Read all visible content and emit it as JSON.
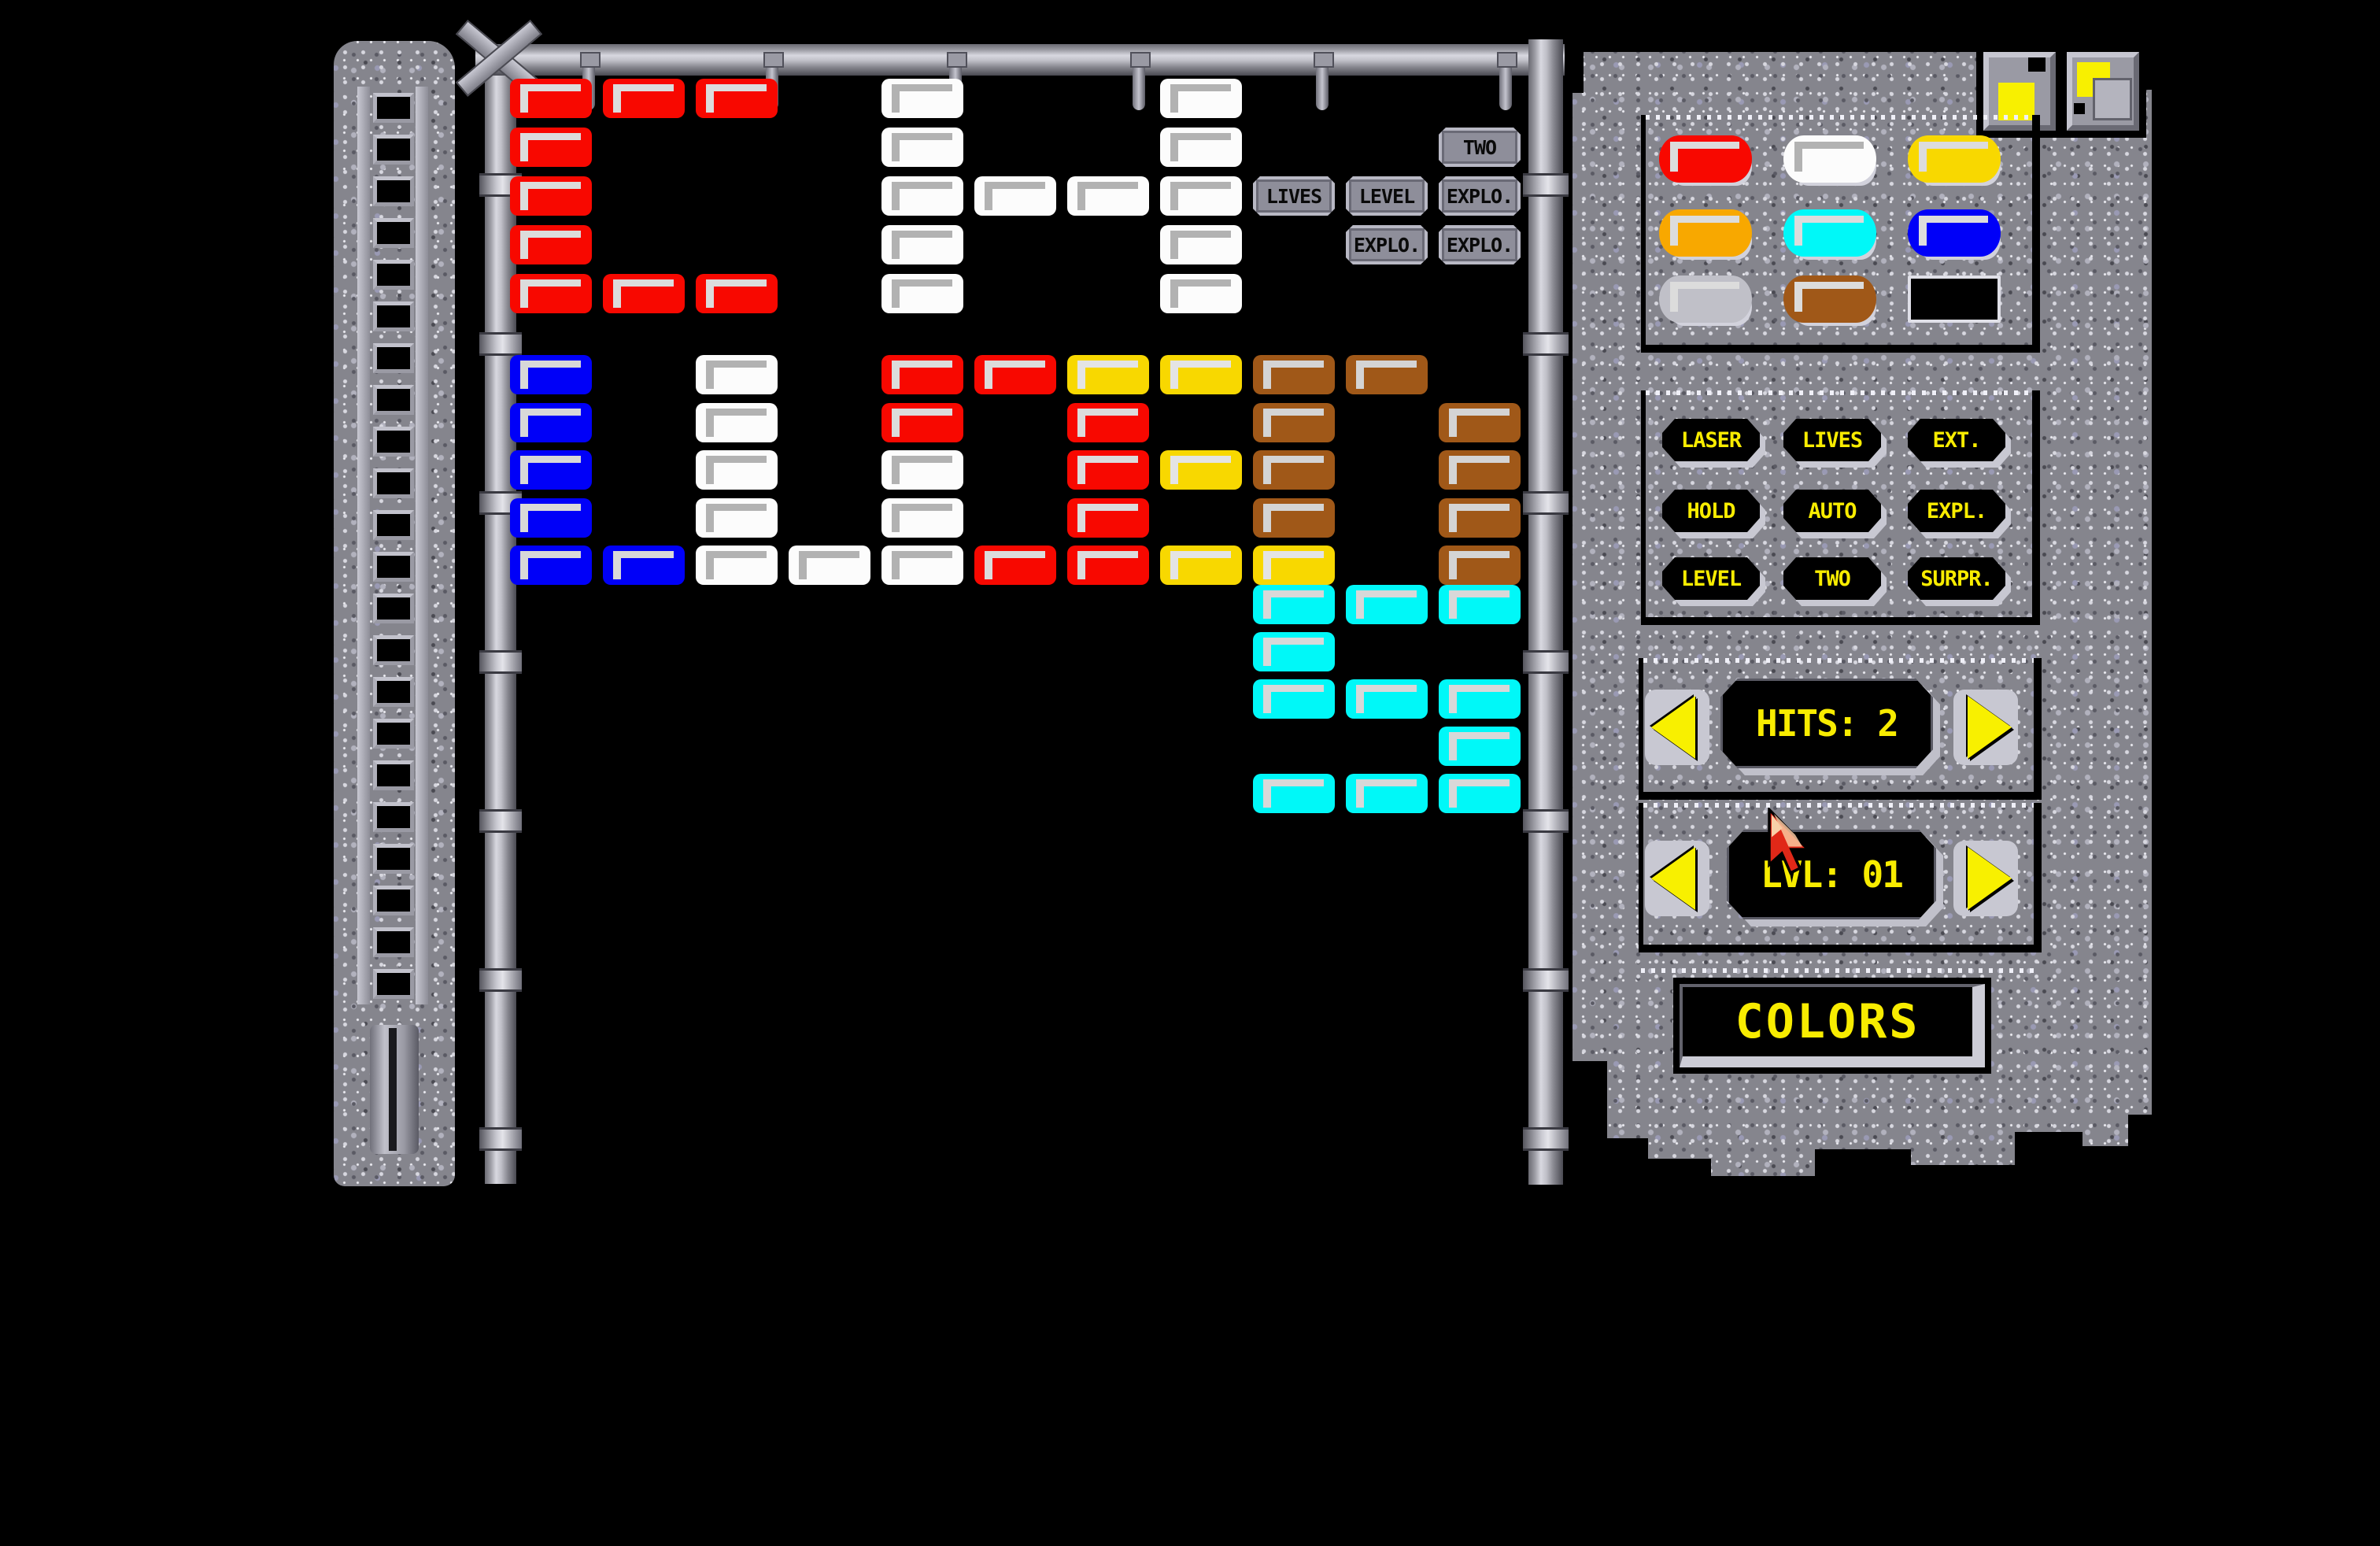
{
  "window": {
    "top_icons": [
      "maximize",
      "restore-overlap"
    ]
  },
  "playfield": {
    "grid": {
      "cols": 11,
      "rows": 15
    },
    "brick_colors": {
      "red": "#f80800",
      "white": "#fcfcfc",
      "blue": "#0000f8",
      "yellow": "#f8d800",
      "brown": "#a05818",
      "cyan": "#00f8f8",
      "metal": "#8e8e9a"
    },
    "bricks": [
      {
        "r": 0,
        "c": 0,
        "t": "red"
      },
      {
        "r": 0,
        "c": 1,
        "t": "red"
      },
      {
        "r": 0,
        "c": 2,
        "t": "red"
      },
      {
        "r": 0,
        "c": 4,
        "t": "white"
      },
      {
        "r": 0,
        "c": 7,
        "t": "white"
      },
      {
        "r": 1,
        "c": 0,
        "t": "red"
      },
      {
        "r": 1,
        "c": 4,
        "t": "white"
      },
      {
        "r": 1,
        "c": 7,
        "t": "white"
      },
      {
        "r": 1,
        "c": 10,
        "t": "metal",
        "label": "TWO"
      },
      {
        "r": 2,
        "c": 0,
        "t": "red"
      },
      {
        "r": 2,
        "c": 4,
        "t": "white"
      },
      {
        "r": 2,
        "c": 5,
        "t": "white"
      },
      {
        "r": 2,
        "c": 6,
        "t": "white"
      },
      {
        "r": 2,
        "c": 7,
        "t": "white"
      },
      {
        "r": 2,
        "c": 8,
        "t": "metal",
        "label": "LIVES"
      },
      {
        "r": 2,
        "c": 9,
        "t": "metal",
        "label": "LEVEL"
      },
      {
        "r": 2,
        "c": 10,
        "t": "metal",
        "label": "EXPLO."
      },
      {
        "r": 3,
        "c": 0,
        "t": "red"
      },
      {
        "r": 3,
        "c": 4,
        "t": "white"
      },
      {
        "r": 3,
        "c": 7,
        "t": "white"
      },
      {
        "r": 3,
        "c": 9,
        "t": "metal",
        "label": "EXPLO."
      },
      {
        "r": 3,
        "c": 10,
        "t": "metal",
        "label": "EXPLO."
      },
      {
        "r": 4,
        "c": 0,
        "t": "red"
      },
      {
        "r": 4,
        "c": 1,
        "t": "red"
      },
      {
        "r": 4,
        "c": 2,
        "t": "red"
      },
      {
        "r": 4,
        "c": 4,
        "t": "white"
      },
      {
        "r": 4,
        "c": 7,
        "t": "white"
      },
      {
        "r": 5,
        "c": 0,
        "t": "blue"
      },
      {
        "r": 5,
        "c": 2,
        "t": "white"
      },
      {
        "r": 5,
        "c": 4,
        "t": "red"
      },
      {
        "r": 5,
        "c": 5,
        "t": "red"
      },
      {
        "r": 5,
        "c": 6,
        "t": "yellow"
      },
      {
        "r": 5,
        "c": 7,
        "t": "yellow"
      },
      {
        "r": 5,
        "c": 8,
        "t": "brown"
      },
      {
        "r": 5,
        "c": 9,
        "t": "brown"
      },
      {
        "r": 6,
        "c": 0,
        "t": "blue"
      },
      {
        "r": 6,
        "c": 2,
        "t": "white"
      },
      {
        "r": 6,
        "c": 4,
        "t": "red"
      },
      {
        "r": 6,
        "c": 6,
        "t": "red"
      },
      {
        "r": 6,
        "c": 8,
        "t": "brown"
      },
      {
        "r": 6,
        "c": 10,
        "t": "brown"
      },
      {
        "r": 7,
        "c": 0,
        "t": "blue"
      },
      {
        "r": 7,
        "c": 2,
        "t": "white"
      },
      {
        "r": 7,
        "c": 4,
        "t": "white"
      },
      {
        "r": 7,
        "c": 6,
        "t": "red"
      },
      {
        "r": 7,
        "c": 7,
        "t": "yellow"
      },
      {
        "r": 7,
        "c": 8,
        "t": "brown"
      },
      {
        "r": 7,
        "c": 10,
        "t": "brown"
      },
      {
        "r": 8,
        "c": 0,
        "t": "blue"
      },
      {
        "r": 8,
        "c": 2,
        "t": "white"
      },
      {
        "r": 8,
        "c": 4,
        "t": "white"
      },
      {
        "r": 8,
        "c": 6,
        "t": "red"
      },
      {
        "r": 8,
        "c": 8,
        "t": "brown"
      },
      {
        "r": 8,
        "c": 10,
        "t": "brown"
      },
      {
        "r": 9,
        "c": 0,
        "t": "blue"
      },
      {
        "r": 9,
        "c": 1,
        "t": "blue"
      },
      {
        "r": 9,
        "c": 2,
        "t": "white"
      },
      {
        "r": 9,
        "c": 3,
        "t": "white"
      },
      {
        "r": 9,
        "c": 4,
        "t": "white"
      },
      {
        "r": 9,
        "c": 5,
        "t": "red"
      },
      {
        "r": 9,
        "c": 6,
        "t": "red"
      },
      {
        "r": 9,
        "c": 7,
        "t": "yellow"
      },
      {
        "r": 9,
        "c": 8,
        "t": "yellow"
      },
      {
        "r": 9,
        "c": 10,
        "t": "brown"
      },
      {
        "r": 10,
        "c": 8,
        "t": "cyan"
      },
      {
        "r": 10,
        "c": 9,
        "t": "cyan"
      },
      {
        "r": 10,
        "c": 10,
        "t": "cyan"
      },
      {
        "r": 11,
        "c": 8,
        "t": "cyan"
      },
      {
        "r": 12,
        "c": 8,
        "t": "cyan"
      },
      {
        "r": 12,
        "c": 9,
        "t": "cyan"
      },
      {
        "r": 12,
        "c": 10,
        "t": "cyan"
      },
      {
        "r": 13,
        "c": 10,
        "t": "cyan"
      },
      {
        "r": 14,
        "c": 8,
        "t": "cyan"
      },
      {
        "r": 14,
        "c": 9,
        "t": "cyan"
      },
      {
        "r": 14,
        "c": 10,
        "t": "cyan"
      }
    ]
  },
  "side_panel": {
    "palette": {
      "swatches": [
        {
          "name": "red",
          "hex": "#f80800"
        },
        {
          "name": "white",
          "hex": "#fcfcfc"
        },
        {
          "name": "yellow",
          "hex": "#f8d800"
        },
        {
          "name": "orange",
          "hex": "#f8a800"
        },
        {
          "name": "cyan",
          "hex": "#00f8f8"
        },
        {
          "name": "blue",
          "hex": "#0000f8"
        },
        {
          "name": "silver",
          "hex": "#c0c0c8"
        },
        {
          "name": "brown",
          "hex": "#a05818"
        },
        {
          "name": "black",
          "hex": "#000000"
        }
      ]
    },
    "attribute_buttons": [
      "LASER",
      "LIVES",
      "EXT.",
      "HOLD",
      "AUTO",
      "EXPL.",
      "LEVEL",
      "TWO",
      "SURPR."
    ],
    "hits": {
      "label": "HITS:",
      "value": "2"
    },
    "level": {
      "label": "LVL:",
      "value": "01"
    },
    "colors_button_label": "COLORS",
    "accent_text_color": "#f8ec00"
  }
}
